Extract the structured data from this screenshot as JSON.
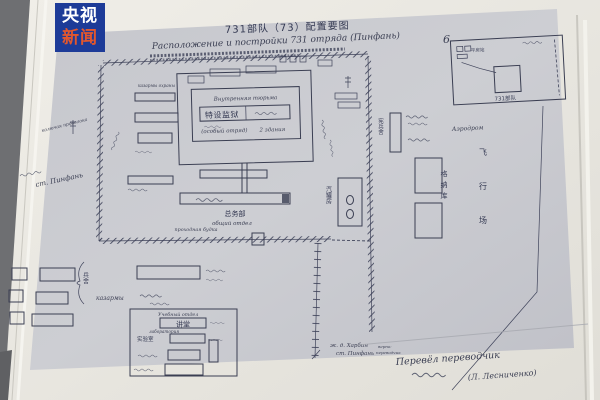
{
  "watermark": {
    "line1": "央视",
    "line2": "新闻"
  },
  "colors": {
    "logo_bg": "#1d3b98",
    "logo_accent": "#e2572e",
    "paper": "#cbccd1",
    "ink": "#3a3e52"
  },
  "title": {
    "cn": "731部队（73）配置要图",
    "ru": "Расположение и постройки 731 отряда (Пинфань)",
    "page": "6"
  },
  "inset": {
    "station": "平房站",
    "site": "731部队"
  },
  "compound": {
    "guard_ru": "казармы охраны",
    "prison_label_ru": "Внутренняя тюрьма",
    "prison_cn": "特设监狱",
    "prison_note1": "(особый отряд)",
    "prison_note2": "2 здания",
    "general_cn": "总务部",
    "general_ru": "общий отдел",
    "gatehouse_ru": "проходная будка",
    "boiler_cn": "汽罐房"
  },
  "right": {
    "mp_cn": "宪兵舍",
    "aerodrome_ru": "Аэродром",
    "hangar_cn": "格纳库",
    "airfield_cn": "飞行场"
  },
  "left": {
    "wire_ru": "колючая проволока",
    "station_ru": "ст. Пинфань"
  },
  "railway": {
    "line1": "ж. д. Харбин",
    "line2": "ст. Пинфань"
  },
  "barracks": {
    "label_cn": "兵舍",
    "label_ru": "казармы"
  },
  "training": {
    "title_ru": "Учебный отдел",
    "hall_cn": "讲堂",
    "lab_ru": "лаборатория",
    "lab_cn": "实验室"
  },
  "signature": {
    "verify1": "верно:",
    "verify2": "переводчик",
    "line": "Перевёл переводчик",
    "name": "(Л. Лесниченко)"
  }
}
